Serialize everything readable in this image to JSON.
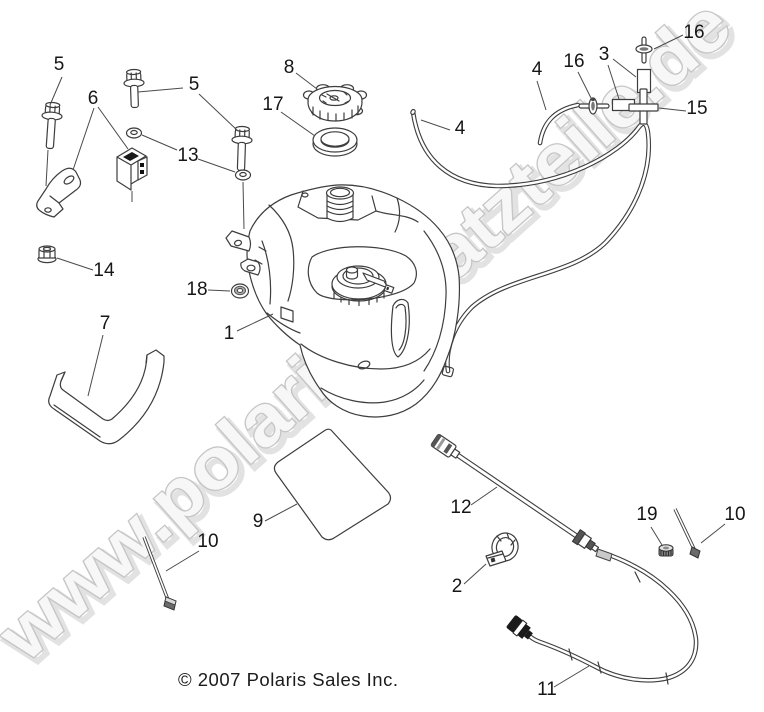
{
  "page": {
    "bg": "#ffffff",
    "line_color": "#3d3d3d"
  },
  "diagram": {
    "kind": "exploded-parts-diagram",
    "subject": "fuel-tank-assembly"
  },
  "watermark": {
    "text": "www.polarisersatzteile.de",
    "outline": "#c6c6c6",
    "fill": "#f7f7f7",
    "shadow": "#e2e2e2"
  },
  "copyright": {
    "text": "© 2007 Polaris Sales Inc."
  },
  "callouts": [
    {
      "num": "5",
      "x": 59,
      "y": 70,
      "part": "flange-bolt"
    },
    {
      "num": "6",
      "x": 93,
      "y": 104,
      "part": "mount-bracket"
    },
    {
      "num": "5",
      "x": 194,
      "y": 90,
      "part": "flange-bolt"
    },
    {
      "num": "8",
      "x": 289,
      "y": 73,
      "part": "fuel-cap"
    },
    {
      "num": "17",
      "x": 273,
      "y": 110,
      "part": "cap-gasket"
    },
    {
      "num": "13",
      "x": 188,
      "y": 161,
      "part": "washer"
    },
    {
      "num": "14",
      "x": 104,
      "y": 276,
      "part": "nut"
    },
    {
      "num": "18",
      "x": 197,
      "y": 295,
      "part": "grommet"
    },
    {
      "num": "1",
      "x": 229,
      "y": 339,
      "part": "fuel-tank"
    },
    {
      "num": "7",
      "x": 105,
      "y": 329,
      "part": "heat-shield"
    },
    {
      "num": "4",
      "x": 537,
      "y": 75,
      "part": "vent-hose"
    },
    {
      "num": "16",
      "x": 574,
      "y": 67,
      "part": "clip"
    },
    {
      "num": "3",
      "x": 604,
      "y": 60,
      "part": "fitting"
    },
    {
      "num": "16",
      "x": 694,
      "y": 38,
      "part": "clip"
    },
    {
      "num": "15",
      "x": 697,
      "y": 114,
      "part": "cross-fitting"
    },
    {
      "num": "4",
      "x": 460,
      "y": 134,
      "part": "vent-hose"
    },
    {
      "num": "9",
      "x": 258,
      "y": 527,
      "part": "pad-decal"
    },
    {
      "num": "10",
      "x": 208,
      "y": 547,
      "part": "screw"
    },
    {
      "num": "12",
      "x": 461,
      "y": 513,
      "part": "fuel-line"
    },
    {
      "num": "2",
      "x": 457,
      "y": 592,
      "part": "cable-clamp"
    },
    {
      "num": "19",
      "x": 647,
      "y": 520,
      "part": "cap-nut"
    },
    {
      "num": "10",
      "x": 735,
      "y": 520,
      "part": "screw"
    },
    {
      "num": "11",
      "x": 547,
      "y": 695,
      "part": "fuel-hose"
    }
  ]
}
